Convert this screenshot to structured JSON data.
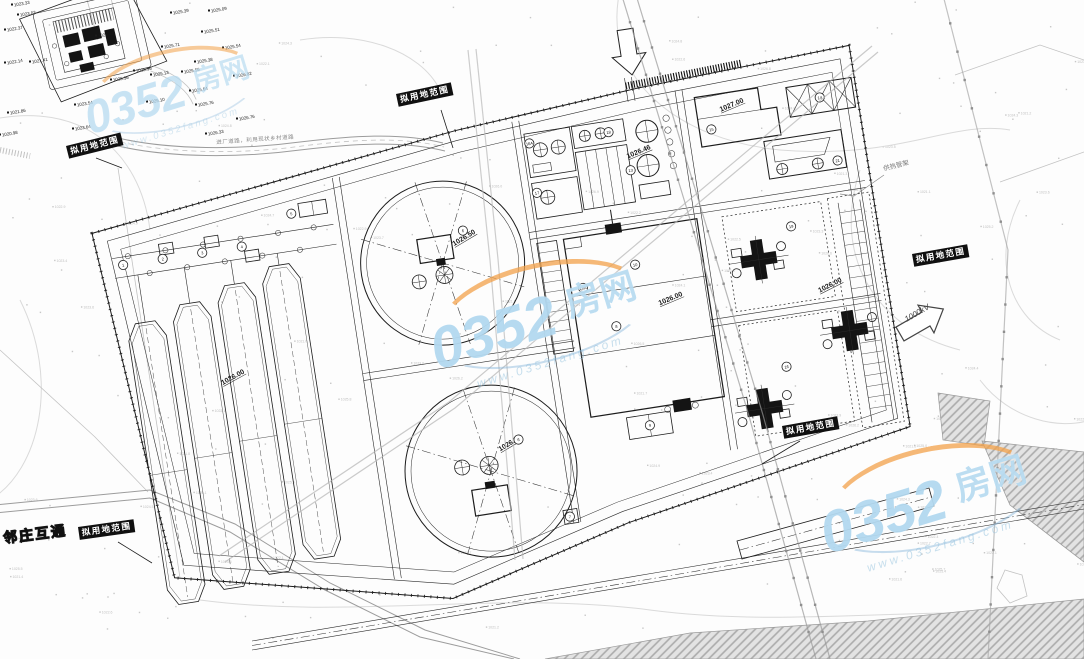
{
  "meta": {
    "width": 1084,
    "height": 659,
    "drawing_type": "sewage-treatment-plant-site-plan"
  },
  "colors": {
    "ink": "#1c1c1c",
    "faint_terrain": "#c8c8c8",
    "road_gray": "#b0b0b0",
    "label_bg": "#101010",
    "wm_blue": "#9ecee8",
    "wm_orange": "#f2a24c"
  },
  "labels": {
    "boundary": [
      {
        "text": "拟用地范围",
        "x": 396,
        "y": 94,
        "r": -12
      },
      {
        "text": "拟用地范围",
        "x": 66,
        "y": 146,
        "r": -14
      },
      {
        "text": "拟用地范围",
        "x": 912,
        "y": 254,
        "r": -10
      },
      {
        "text": "拟用地范围",
        "x": 782,
        "y": 426,
        "r": -10
      },
      {
        "text": "拟用地范围",
        "x": 78,
        "y": 527,
        "r": -8
      }
    ],
    "interchange": {
      "text": "邻庄互通",
      "x": 2,
      "y": 528,
      "r": -7
    },
    "heat_rack": {
      "text": "供热管架",
      "x": 882,
      "y": 163,
      "r": -14
    },
    "road": {
      "text": "进厂道路，利用现状乡村道路",
      "x": 216,
      "y": 138,
      "r": -4
    },
    "kv": {
      "text": "1000kV",
      "x": 903,
      "y": 316,
      "r": -30
    }
  },
  "watermark": {
    "number": "0352",
    "suffix": "房网",
    "url": "www.0352fang.com",
    "spots": [
      {
        "x": 60,
        "y": 40,
        "s": 0.8,
        "o": 0.7
      },
      {
        "x": 432,
        "y": 268,
        "s": 1.0,
        "o": 0.95
      },
      {
        "x": 822,
        "y": 452,
        "s": 1.0,
        "o": 0.95
      }
    ]
  },
  "site_elevations": [
    [
      276,
      140,
      -22,
      "1026.50"
    ],
    [
      290,
      350,
      -22,
      "1026.50"
    ],
    [
      560,
      48,
      -14,
      "1027.00"
    ],
    [
      470,
      230,
      -14,
      "1026.00"
    ],
    [
      630,
      242,
      -18,
      "1026.00"
    ],
    [
      26,
      242,
      -20,
      "1026.00"
    ],
    [
      461,
      80,
      -14,
      "1026.46"
    ]
  ],
  "equipment_tags": [
    [
      -54,
      108,
      "1"
    ],
    [
      -14,
      108,
      "2"
    ],
    [
      26,
      108,
      "3"
    ],
    [
      66,
      108,
      "4"
    ],
    [
      120,
      83,
      "5"
    ],
    [
      287,
      126,
      "6"
    ],
    [
      310,
      341,
      "6"
    ],
    [
      349,
      425,
      "7"
    ],
    [
      424,
      244,
      "8"
    ],
    [
      442,
      347,
      "9"
    ],
    [
      452,
      186,
      "10"
    ],
    [
      397,
      201,
      "10A"
    ],
    [
      462,
      92,
      "13"
    ],
    [
      660,
      49,
      "14"
    ],
    [
      548,
      64,
      "15"
    ],
    [
      366,
      50,
      "16A"
    ],
    [
      366,
      100,
      "17"
    ],
    [
      446,
      51,
      "18"
    ],
    [
      612,
      172,
      "19"
    ],
    [
      586,
      310,
      "16"
    ],
    [
      668,
      114,
      "21"
    ]
  ],
  "spot_elevations": [
    [
      14,
      5,
      "1023.33"
    ],
    [
      20,
      15,
      "1023.03"
    ],
    [
      7,
      30,
      "1022.37"
    ],
    [
      7,
      63,
      "1022.14"
    ],
    [
      32,
      62,
      "1021.41"
    ],
    [
      10,
      113,
      "1021.86"
    ],
    [
      2,
      135,
      "1020.98"
    ],
    [
      75,
      129,
      "1023.64"
    ],
    [
      113,
      80,
      "1025.36"
    ],
    [
      77,
      105,
      "1023.54"
    ],
    [
      98,
      36,
      "1025.43"
    ],
    [
      173,
      13,
      "1025.39"
    ],
    [
      211,
      11,
      "1025.09"
    ],
    [
      204,
      32,
      "1025.51"
    ],
    [
      164,
      47,
      "1025.71"
    ],
    [
      225,
      48,
      "1025.54"
    ],
    [
      197,
      62,
      "1025.38"
    ],
    [
      136,
      71,
      "1025.96"
    ],
    [
      153,
      75,
      "1025.13"
    ],
    [
      184,
      72,
      "1025.56"
    ],
    [
      236,
      76,
      "1026.02"
    ],
    [
      192,
      91,
      "1025.64"
    ],
    [
      149,
      102,
      "1025.10"
    ],
    [
      198,
      105,
      "1025.76"
    ],
    [
      239,
      119,
      "1026.76"
    ],
    [
      208,
      134,
      "1026.33"
    ]
  ]
}
